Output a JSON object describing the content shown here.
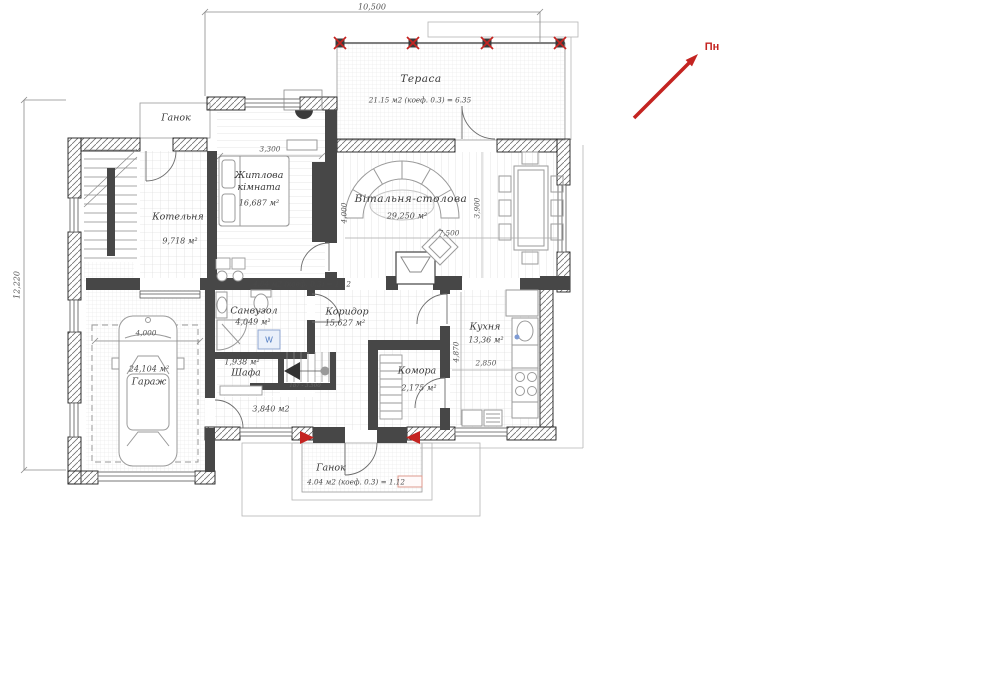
{
  "colors": {
    "north_arrow_red": "#c42421",
    "marker_red": "#c42421",
    "wall_dark": "#474747",
    "washer_blue": "#4a77c0",
    "highlight_salmon": "#dd9a8e"
  },
  "north": {
    "label": "Пн"
  },
  "dims": {
    "overall_width": "10,500",
    "overall_height": "12,220",
    "bedroom_width": "3,300",
    "hall_width": "7,500",
    "hall_height": "3,900",
    "room_height": "4,000",
    "kitchen_height": "4,870",
    "kitchen_width": "2,850",
    "garage_width": "4,000",
    "stair_note": "187 - 3.500"
  },
  "rooms": {
    "terrace": {
      "name": "Тераса",
      "area": "21.15 м2 (коеф. 0.3) = 6.35"
    },
    "porch_top": {
      "name": "Ганок"
    },
    "boiler": {
      "name": "Котельня",
      "area": "9,718 м²"
    },
    "bedroom": {
      "name": "Житлова кімната",
      "area": "16,687 м²"
    },
    "hall": {
      "name": "Вітальня-столова",
      "area": "29,250 м²"
    },
    "bathroom": {
      "name": "Санвузол",
      "area": "4,049 м²"
    },
    "corridor": {
      "name": "Коридор",
      "area": "15,627 м²"
    },
    "kitchen": {
      "name": "Кухня",
      "area": "13,36 м²"
    },
    "closet": {
      "name": "Шафа",
      "area": "1,938 м²"
    },
    "stair_hall": {
      "area": "3,840 м2"
    },
    "garage": {
      "name": "Гараж",
      "area": "24,104 м²"
    },
    "pantry": {
      "name": "Комора",
      "area": "2,175 м²"
    },
    "porch_bottom": {
      "name": "Ганок",
      "area": "4.04 м2 (коеф. 0.3) = 1.12"
    }
  },
  "notes": {
    "corridor_coef": "4.04 м2 (коеф. 0.3) = 1.12",
    "washer": "W"
  }
}
